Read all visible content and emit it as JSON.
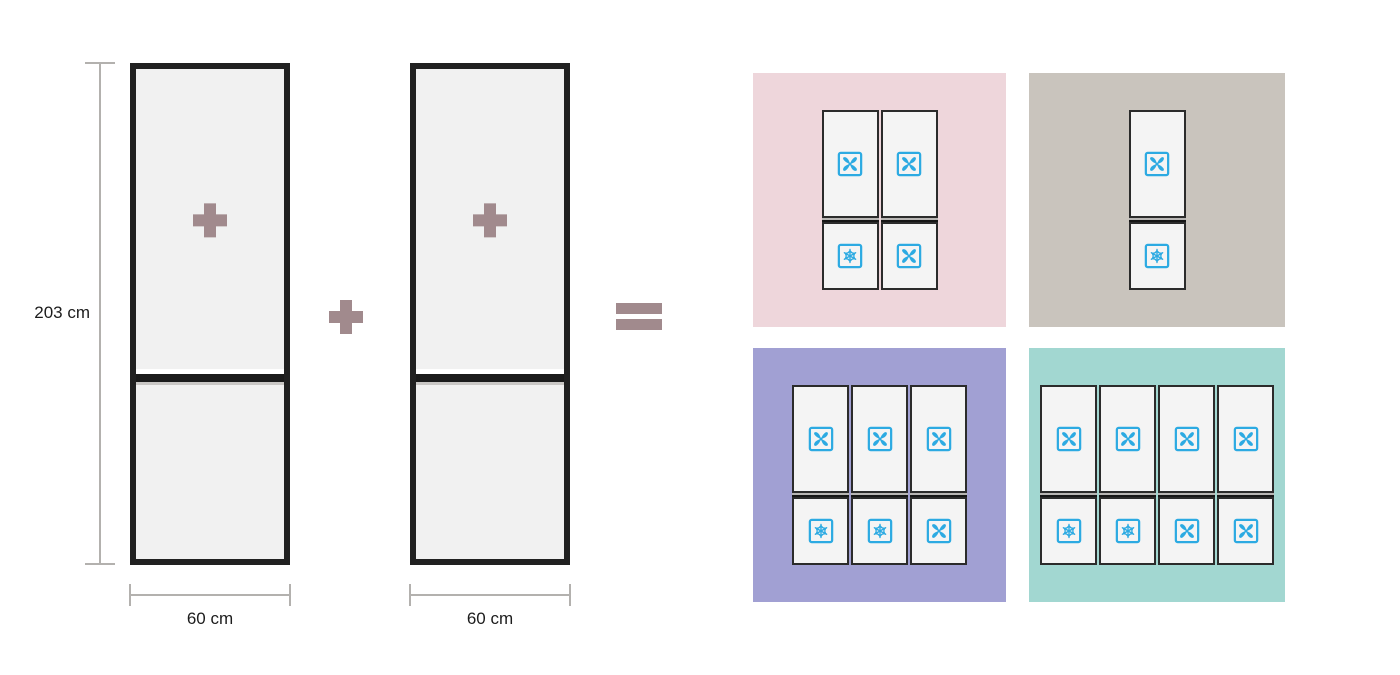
{
  "colors": {
    "operator_mauve": "#a18a8d",
    "icon_blue": "#2caae2",
    "dimension_gray": "#b3b1ae",
    "fridge_fill": "#f1f1f1",
    "fridge_border": "#212121",
    "door_fill": "#f4f4f4"
  },
  "left": {
    "height_label": "203 cm",
    "fridge_width_labels": [
      "60 cm",
      "60 cm"
    ],
    "fridge_badge_icon": "plus-icon",
    "operators": {
      "combine": "plus-icon",
      "result": "equals-icon"
    }
  },
  "panels": [
    {
      "name": "pink",
      "bg": "#eed6db",
      "columns": [
        {
          "top": "fan",
          "bottom": "snowflake"
        },
        {
          "top": "fan",
          "bottom": "fan"
        }
      ]
    },
    {
      "name": "taupe",
      "bg": "#c9c4bd",
      "columns": [
        {
          "top": "fan",
          "bottom": "snowflake"
        }
      ]
    },
    {
      "name": "purple",
      "bg": "#a1a0d3",
      "columns": [
        {
          "top": "fan",
          "bottom": "snowflake"
        },
        {
          "top": "fan",
          "bottom": "snowflake"
        },
        {
          "top": "fan",
          "bottom": "fan"
        }
      ]
    },
    {
      "name": "teal",
      "bg": "#a2d7d1",
      "columns": [
        {
          "top": "fan",
          "bottom": "snowflake"
        },
        {
          "top": "fan",
          "bottom": "snowflake"
        },
        {
          "top": "fan",
          "bottom": "fan"
        },
        {
          "top": "fan",
          "bottom": "fan"
        }
      ]
    }
  ]
}
